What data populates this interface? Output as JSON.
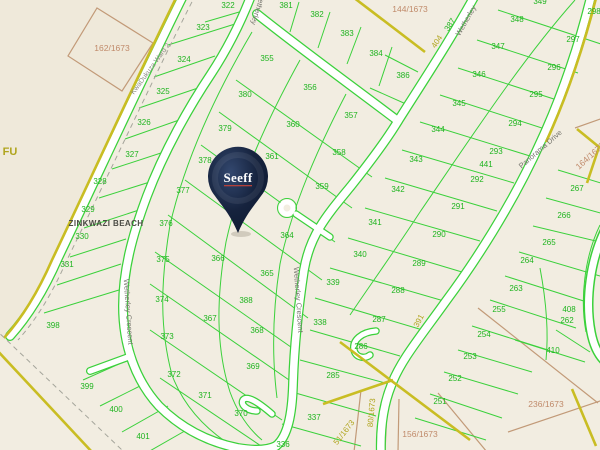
{
  "map": {
    "place_label": "ZINKWAZI BEACH",
    "ward_label": "KwaDukuza Ward 2",
    "pin": {
      "label": "Seeff",
      "color": "#16233e",
      "underline": "#b5413a"
    },
    "road_names": [
      "Wetherley Crescent",
      "Panorama Drive"
    ],
    "colors": {
      "background": "#f2ede1",
      "parcel_line_green": "#3bd13b",
      "parcel_text_green": "#1fb41f",
      "deed_text_brown": "#c08a6a",
      "farm_text_olive": "#b0a51e",
      "boundary_yellow": "#c9bd23",
      "road_fill": "#ffffff",
      "pin_navy": "#16233e"
    },
    "labels": [
      {
        "t": "322",
        "x": 228,
        "y": 8,
        "cls": "plot"
      },
      {
        "t": "323",
        "x": 203,
        "y": 30,
        "cls": "plot"
      },
      {
        "t": "324",
        "x": 184,
        "y": 62,
        "cls": "plot"
      },
      {
        "t": "325",
        "x": 163,
        "y": 94,
        "cls": "plot"
      },
      {
        "t": "326",
        "x": 144,
        "y": 125,
        "cls": "plot"
      },
      {
        "t": "327",
        "x": 132,
        "y": 157,
        "cls": "plot"
      },
      {
        "t": "328",
        "x": 100,
        "y": 184,
        "cls": "plot"
      },
      {
        "t": "329",
        "x": 88,
        "y": 212,
        "cls": "plot"
      },
      {
        "t": "330",
        "x": 82,
        "y": 239,
        "cls": "plot"
      },
      {
        "t": "331",
        "x": 67,
        "y": 267,
        "cls": "plot"
      },
      {
        "t": "398",
        "x": 53,
        "y": 328,
        "cls": "plot"
      },
      {
        "t": "399",
        "x": 87,
        "y": 389,
        "cls": "plot"
      },
      {
        "t": "400",
        "x": 116,
        "y": 412,
        "cls": "plot"
      },
      {
        "t": "401",
        "x": 143,
        "y": 439,
        "cls": "plot"
      },
      {
        "t": "381",
        "x": 286,
        "y": 8,
        "cls": "plot"
      },
      {
        "t": "382",
        "x": 317,
        "y": 17,
        "cls": "plot"
      },
      {
        "t": "383",
        "x": 347,
        "y": 36,
        "cls": "plot"
      },
      {
        "t": "384",
        "x": 376,
        "y": 56,
        "cls": "plot"
      },
      {
        "t": "386",
        "x": 403,
        "y": 78,
        "cls": "plot"
      },
      {
        "t": "355",
        "x": 267,
        "y": 61,
        "cls": "plot"
      },
      {
        "t": "356",
        "x": 310,
        "y": 90,
        "cls": "plot"
      },
      {
        "t": "357",
        "x": 351,
        "y": 118,
        "cls": "plot"
      },
      {
        "t": "380",
        "x": 245,
        "y": 97,
        "cls": "plot"
      },
      {
        "t": "360",
        "x": 293,
        "y": 127,
        "cls": "plot"
      },
      {
        "t": "379",
        "x": 225,
        "y": 131,
        "cls": "plot"
      },
      {
        "t": "361",
        "x": 272,
        "y": 159,
        "cls": "plot"
      },
      {
        "t": "358",
        "x": 339,
        "y": 155,
        "cls": "plot"
      },
      {
        "t": "359",
        "x": 322,
        "y": 189,
        "cls": "plot"
      },
      {
        "t": "378",
        "x": 205,
        "y": 163,
        "cls": "plot"
      },
      {
        "t": "377",
        "x": 183,
        "y": 193,
        "cls": "plot"
      },
      {
        "t": "376",
        "x": 166,
        "y": 226,
        "cls": "plot"
      },
      {
        "t": "375",
        "x": 163,
        "y": 262,
        "cls": "plot"
      },
      {
        "t": "374",
        "x": 162,
        "y": 302,
        "cls": "plot"
      },
      {
        "t": "373",
        "x": 167,
        "y": 339,
        "cls": "plot"
      },
      {
        "t": "372",
        "x": 174,
        "y": 377,
        "cls": "plot"
      },
      {
        "t": "371",
        "x": 205,
        "y": 398,
        "cls": "plot"
      },
      {
        "t": "370",
        "x": 241,
        "y": 416,
        "cls": "plot"
      },
      {
        "t": "366",
        "x": 218,
        "y": 261,
        "cls": "plot"
      },
      {
        "t": "365",
        "x": 267,
        "y": 276,
        "cls": "plot"
      },
      {
        "t": "364",
        "x": 287,
        "y": 238,
        "cls": "plot"
      },
      {
        "t": "388",
        "x": 246,
        "y": 303,
        "cls": "plot"
      },
      {
        "t": "367",
        "x": 210,
        "y": 321,
        "cls": "plot"
      },
      {
        "t": "368",
        "x": 257,
        "y": 333,
        "cls": "plot"
      },
      {
        "t": "369",
        "x": 253,
        "y": 369,
        "cls": "plot"
      },
      {
        "t": "336",
        "x": 283,
        "y": 447,
        "cls": "plot"
      },
      {
        "t": "337",
        "x": 314,
        "y": 420,
        "cls": "plot"
      },
      {
        "t": "285",
        "x": 333,
        "y": 378,
        "cls": "plot"
      },
      {
        "t": "286",
        "x": 361,
        "y": 349,
        "cls": "plot"
      },
      {
        "t": "287",
        "x": 379,
        "y": 322,
        "cls": "plot"
      },
      {
        "t": "288",
        "x": 398,
        "y": 293,
        "cls": "plot"
      },
      {
        "t": "289",
        "x": 419,
        "y": 266,
        "cls": "plot"
      },
      {
        "t": "290",
        "x": 439,
        "y": 237,
        "cls": "plot"
      },
      {
        "t": "291",
        "x": 458,
        "y": 209,
        "cls": "plot"
      },
      {
        "t": "292",
        "x": 477,
        "y": 182,
        "cls": "plot"
      },
      {
        "t": "441",
        "x": 486,
        "y": 167,
        "cls": "plot"
      },
      {
        "t": "293",
        "x": 496,
        "y": 154,
        "cls": "plot"
      },
      {
        "t": "294",
        "x": 515,
        "y": 126,
        "cls": "plot"
      },
      {
        "t": "295",
        "x": 536,
        "y": 97,
        "cls": "plot"
      },
      {
        "t": "296",
        "x": 554,
        "y": 70,
        "cls": "plot"
      },
      {
        "t": "297",
        "x": 573,
        "y": 42,
        "cls": "plot"
      },
      {
        "t": "298",
        "x": 594,
        "y": 14,
        "cls": "plot"
      },
      {
        "t": "338",
        "x": 320,
        "y": 325,
        "cls": "plot"
      },
      {
        "t": "339",
        "x": 333,
        "y": 285,
        "cls": "plot"
      },
      {
        "t": "340",
        "x": 360,
        "y": 257,
        "cls": "plot"
      },
      {
        "t": "341",
        "x": 375,
        "y": 225,
        "cls": "plot"
      },
      {
        "t": "342",
        "x": 398,
        "y": 192,
        "cls": "plot"
      },
      {
        "t": "343",
        "x": 416,
        "y": 162,
        "cls": "plot"
      },
      {
        "t": "344",
        "x": 438,
        "y": 132,
        "cls": "plot"
      },
      {
        "t": "345",
        "x": 459,
        "y": 106,
        "cls": "plot"
      },
      {
        "t": "346",
        "x": 479,
        "y": 77,
        "cls": "plot"
      },
      {
        "t": "347",
        "x": 498,
        "y": 49,
        "cls": "plot"
      },
      {
        "t": "348",
        "x": 517,
        "y": 22,
        "cls": "plot"
      },
      {
        "t": "349",
        "x": 540,
        "y": 4,
        "cls": "plot"
      },
      {
        "t": "267",
        "x": 577,
        "y": 191,
        "cls": "plot"
      },
      {
        "t": "266",
        "x": 564,
        "y": 218,
        "cls": "plot"
      },
      {
        "t": "265",
        "x": 549,
        "y": 245,
        "cls": "plot"
      },
      {
        "t": "264",
        "x": 527,
        "y": 263,
        "cls": "plot"
      },
      {
        "t": "263",
        "x": 516,
        "y": 291,
        "cls": "plot"
      },
      {
        "t": "255",
        "x": 499,
        "y": 312,
        "cls": "plot"
      },
      {
        "t": "254",
        "x": 484,
        "y": 337,
        "cls": "plot"
      },
      {
        "t": "253",
        "x": 470,
        "y": 359,
        "cls": "plot"
      },
      {
        "t": "252",
        "x": 455,
        "y": 381,
        "cls": "plot"
      },
      {
        "t": "251",
        "x": 440,
        "y": 404,
        "cls": "plot"
      },
      {
        "t": "408",
        "x": 569,
        "y": 312,
        "cls": "plot"
      },
      {
        "t": "262",
        "x": 567,
        "y": 323,
        "cls": "plot"
      },
      {
        "t": "410",
        "x": 553,
        "y": 353,
        "cls": "plot"
      },
      {
        "t": "387",
        "x": 452,
        "y": 26,
        "rot": -57,
        "cls": "plot"
      },
      {
        "t": "404",
        "x": 439,
        "y": 43,
        "rot": -57,
        "cls": "farm"
      },
      {
        "t": "391",
        "x": 421,
        "y": 322,
        "rot": -62,
        "cls": "farm"
      },
      {
        "t": "80/1673",
        "x": 374,
        "y": 413,
        "rot": -85,
        "cls": "farm"
      },
      {
        "t": "51/1673",
        "x": 346,
        "y": 434,
        "rot": -52,
        "cls": "farm"
      },
      {
        "t": "FU",
        "x": 10,
        "y": 155,
        "cls": "farm-big"
      },
      {
        "t": "162/1673",
        "x": 112,
        "y": 51,
        "cls": "deed"
      },
      {
        "t": "144/1673",
        "x": 410,
        "y": 12,
        "cls": "deed"
      },
      {
        "t": "164/1673",
        "x": 592,
        "y": 158,
        "rot": -42,
        "cls": "deed"
      },
      {
        "t": "156/1673",
        "x": 420,
        "y": 437,
        "cls": "deed"
      },
      {
        "t": "236/1673",
        "x": 546,
        "y": 407,
        "cls": "deed"
      },
      {
        "t": "Wetherley",
        "x": 256,
        "y": 8,
        "rot": 108,
        "cls": "road"
      },
      {
        "t": "Wetherley",
        "x": 468,
        "y": 22,
        "rot": -60,
        "cls": "road"
      },
      {
        "t": "Wetherley Crescent",
        "x": 126,
        "y": 312,
        "rot": 86,
        "cls": "road"
      },
      {
        "t": "Wetherley Crescent",
        "x": 296,
        "y": 300,
        "rot": 86,
        "cls": "road"
      },
      {
        "t": "Panorama Drive",
        "x": 542,
        "y": 151,
        "rot": -41,
        "cls": "road"
      },
      {
        "t": "KwaDukuza Ward 2",
        "x": 152,
        "y": 70,
        "rot": -54,
        "cls": "ward"
      },
      {
        "t": "ZINKWAZI BEACH",
        "x": 106,
        "y": 226,
        "cls": "place"
      }
    ]
  }
}
